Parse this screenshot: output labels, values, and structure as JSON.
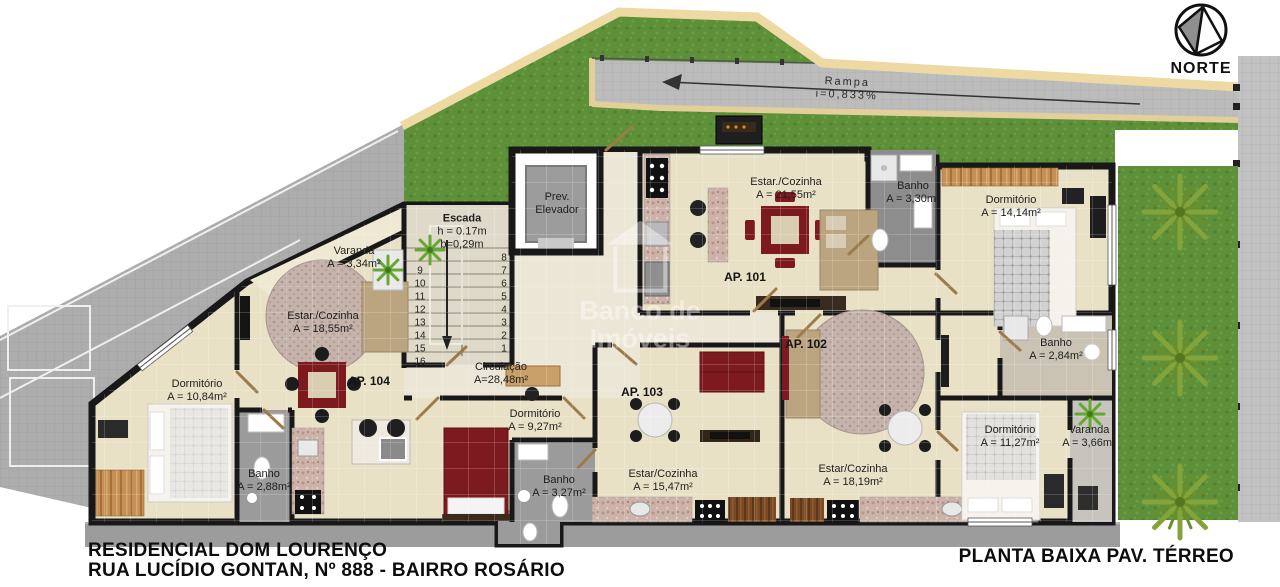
{
  "site": {
    "compass_label": "NORTE",
    "ramp_label": "Rampa",
    "ramp_slope": "i=0,833%"
  },
  "watermark": {
    "line1": "Banco de",
    "line2": "Imóveis"
  },
  "common_areas": {
    "elevator": {
      "line1": "Prev.",
      "line2": "Elevador"
    },
    "stairs": {
      "name": "Escada",
      "riser_height": "h = 0.17m",
      "tread_depth": "b=0,29m",
      "left_numbers": [
        "9",
        "10",
        "11",
        "12",
        "13",
        "14",
        "15",
        "16"
      ],
      "right_numbers": [
        "8",
        "7",
        "6",
        "5",
        "4",
        "3",
        "2",
        "1"
      ]
    },
    "circulation": {
      "name": "Circulação",
      "area": "A=28,48m²"
    }
  },
  "units": [
    {
      "label": "AP. 101",
      "rooms": {
        "living": {
          "name": "Estar./Cozinha",
          "area": "A = 21,55m²"
        },
        "bath": {
          "name": "Banho",
          "area": "A = 3,30m²"
        },
        "bedroom": {
          "name": "Dormitório",
          "area": "A = 14,14m²"
        }
      }
    },
    {
      "label": "AP. 102",
      "rooms": {
        "living": {
          "name": "Estar/Cozinha",
          "area": "A = 18,19m²"
        },
        "bath": {
          "name": "Banho",
          "area": "A = 2,84m²"
        },
        "bedroom": {
          "name": "Dormitório",
          "area": "A = 11,27m²"
        },
        "balcony": {
          "name": "Varanda",
          "area": "A = 3,66m²"
        }
      }
    },
    {
      "label": "AP. 103",
      "rooms": {
        "living": {
          "name": "Estar/Cozinha",
          "area": "A = 15,47m²"
        },
        "bath": {
          "name": "Banho",
          "area": "A = 3,27m²"
        },
        "bedroom": {
          "name": "Dormitório",
          "area": "A = 9,27m²"
        }
      }
    },
    {
      "label": "AP. 104",
      "rooms": {
        "living": {
          "name": "Estar./Cozinha",
          "area": "A = 18,55m²"
        },
        "bath": {
          "name": "Banho",
          "area": "A = 2,88m²"
        },
        "bedroom": {
          "name": "Dormitório",
          "area": "A = 10,84m²"
        },
        "balcony": {
          "name": "Varanda",
          "area": "A = 3,34m²"
        }
      }
    }
  ],
  "footer": {
    "project_name": "RESIDENCIAL DOM LOURENÇO",
    "address": "RUA LUCÍDIO GONTAN, Nº 888 - BAIRRO ROSÁRIO",
    "plan_title": "PLANTA BAIXA PAV. TÉRREO"
  },
  "colors": {
    "wall": "#181818",
    "floor": "#e9e1c6",
    "grass": "#5d9038",
    "paving": "#bcbcbc",
    "curb": "#eed9a2",
    "accent_red": "#7c1a1f"
  }
}
